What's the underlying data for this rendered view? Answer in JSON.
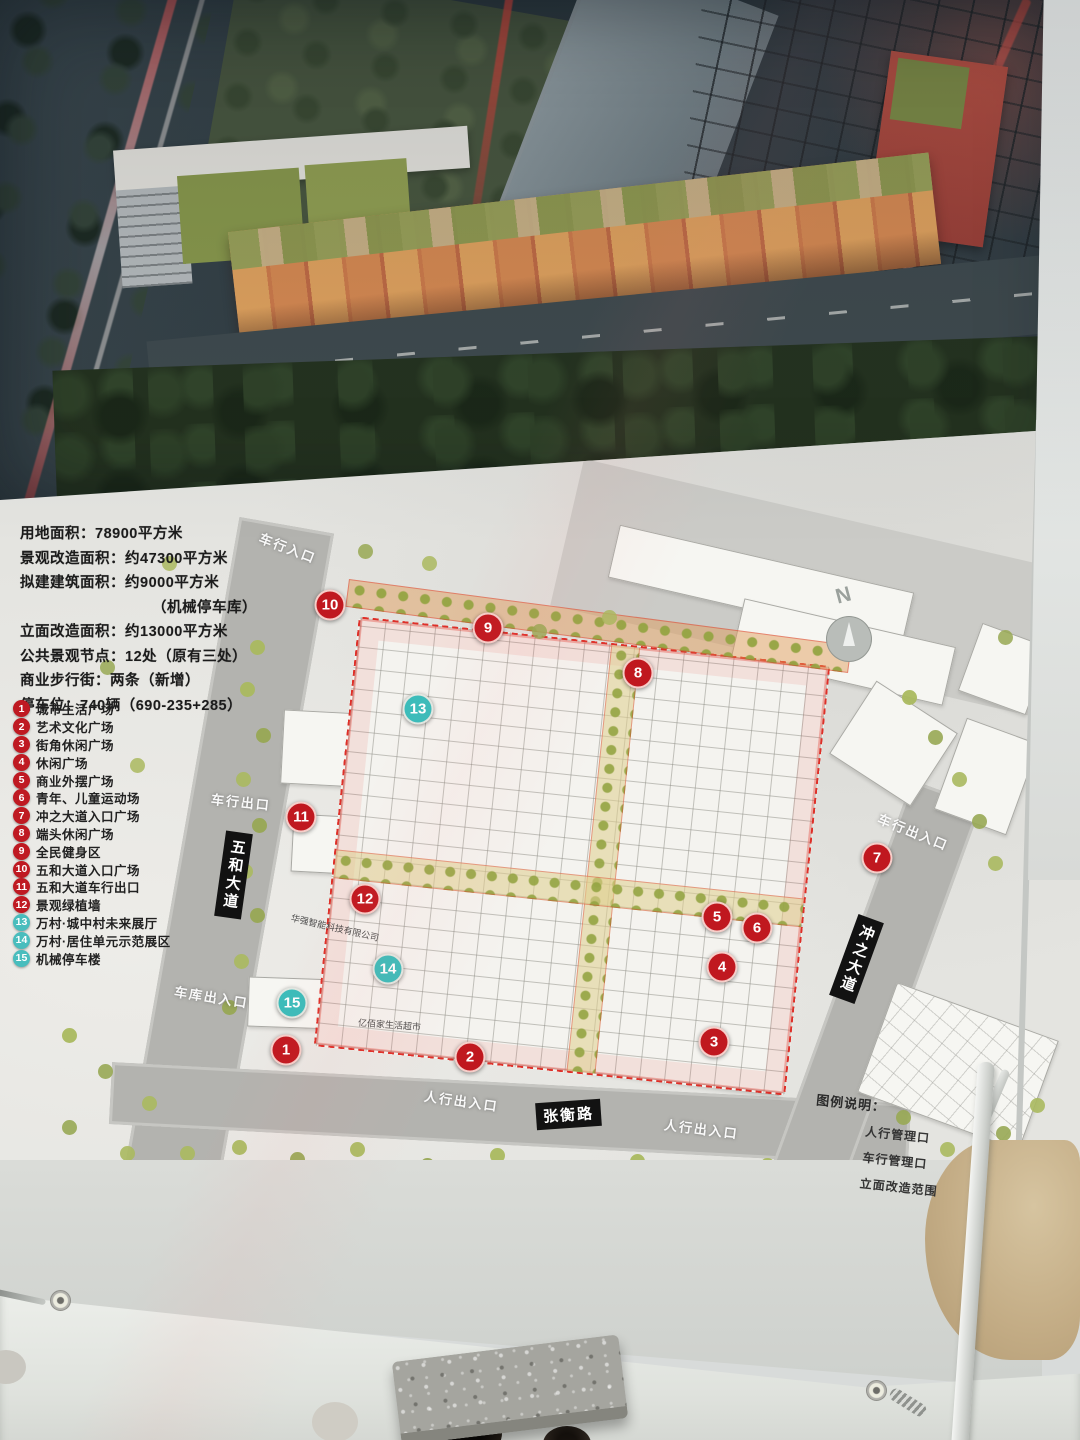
{
  "plan": {
    "stats_lines": [
      {
        "text": "用地面积：78900平方米",
        "indent": false
      },
      {
        "text": "景观改造面积：约47300平方米",
        "indent": false
      },
      {
        "text": "拟建建筑面积：约9000平方米",
        "indent": false
      },
      {
        "text": "（机械停车库）",
        "indent": true
      },
      {
        "text": "立面改造面积：约13000平方米",
        "indent": false
      },
      {
        "text": "公共景观节点：12处（原有三处）",
        "indent": false
      },
      {
        "text": "商业步行街：两条（新增）",
        "indent": false
      },
      {
        "text": "停车位：740辆（690-235+285）",
        "indent": false
      }
    ],
    "legend_items": [
      {
        "num": "1",
        "label": "城市生活广场",
        "color": "red"
      },
      {
        "num": "2",
        "label": "艺术文化广场",
        "color": "red"
      },
      {
        "num": "3",
        "label": "街角休闲广场",
        "color": "red"
      },
      {
        "num": "4",
        "label": "休闲广场",
        "color": "red"
      },
      {
        "num": "5",
        "label": "商业外摆广场",
        "color": "red"
      },
      {
        "num": "6",
        "label": "青年、儿童运动场",
        "color": "red"
      },
      {
        "num": "7",
        "label": "冲之大道入口广场",
        "color": "red"
      },
      {
        "num": "8",
        "label": "端头休闲广场",
        "color": "red"
      },
      {
        "num": "9",
        "label": "全民健身区",
        "color": "red"
      },
      {
        "num": "10",
        "label": "五和大道入口广场",
        "color": "red"
      },
      {
        "num": "11",
        "label": "五和大道车行出口",
        "color": "red"
      },
      {
        "num": "12",
        "label": "景观绿植墙",
        "color": "red"
      },
      {
        "num": "13",
        "label": "万村·城中村未来展厅",
        "color": "teal"
      },
      {
        "num": "14",
        "label": "万村·居住单元示范展区",
        "color": "teal"
      },
      {
        "num": "15",
        "label": "机械停车楼",
        "color": "teal"
      }
    ],
    "markers": [
      {
        "num": "1",
        "color": "red",
        "x": 286,
        "y": 1050
      },
      {
        "num": "2",
        "color": "red",
        "x": 470,
        "y": 1057
      },
      {
        "num": "3",
        "color": "red",
        "x": 714,
        "y": 1042
      },
      {
        "num": "4",
        "color": "red",
        "x": 722,
        "y": 967
      },
      {
        "num": "5",
        "color": "red",
        "x": 717,
        "y": 917
      },
      {
        "num": "6",
        "color": "red",
        "x": 757,
        "y": 928
      },
      {
        "num": "7",
        "color": "red",
        "x": 877,
        "y": 858
      },
      {
        "num": "8",
        "color": "red",
        "x": 638,
        "y": 673
      },
      {
        "num": "9",
        "color": "red",
        "x": 488,
        "y": 628
      },
      {
        "num": "10",
        "color": "red",
        "x": 330,
        "y": 605
      },
      {
        "num": "11",
        "color": "red",
        "x": 301,
        "y": 817
      },
      {
        "num": "12",
        "color": "red",
        "x": 365,
        "y": 899
      },
      {
        "num": "13",
        "color": "teal",
        "x": 418,
        "y": 709
      },
      {
        "num": "14",
        "color": "teal",
        "x": 388,
        "y": 969
      },
      {
        "num": "15",
        "color": "teal",
        "x": 292,
        "y": 1003
      }
    ],
    "map_labels": [
      {
        "name": "entrance-label-vehicle-in",
        "kind": "entrance",
        "text": "车行入口",
        "x": 258,
        "y": 538,
        "rot": 21
      },
      {
        "name": "entrance-label-vehicle-out",
        "kind": "entrance",
        "text": "车行出口",
        "x": 211,
        "y": 792,
        "rot": 6
      },
      {
        "name": "entrance-label-garage",
        "kind": "entrance",
        "text": "车库出入口",
        "x": 174,
        "y": 987,
        "rot": 9
      },
      {
        "name": "entrance-label-pedestrian-sw",
        "kind": "entrance",
        "text": "人行出入口",
        "x": 424,
        "y": 1091,
        "rot": 8
      },
      {
        "name": "entrance-label-pedestrian-se",
        "kind": "entrance",
        "text": "人行出入口",
        "x": 664,
        "y": 1119,
        "rot": 7
      },
      {
        "name": "entrance-label-vehicle-east",
        "kind": "entrance",
        "text": "车行出入口",
        "x": 876,
        "y": 822,
        "rot": 22
      },
      {
        "name": "road-label-wuhe",
        "kind": "roadbox vertical",
        "text": "五和大道",
        "x": 220,
        "y": 832,
        "rot": 8
      },
      {
        "name": "road-label-zhangheng",
        "kind": "roadbox",
        "text": "张衡路",
        "x": 536,
        "y": 1101,
        "rot": -4
      },
      {
        "name": "road-label-chongzhi",
        "kind": "roadbox vertical",
        "text": "冲之大道",
        "x": 843,
        "y": 916,
        "rot": 20
      },
      {
        "name": "building-label-company",
        "kind": "smalltext",
        "text": "华强智能科技有限公司",
        "x": 290,
        "y": 921,
        "rot": 13
      },
      {
        "name": "building-label-supermarket",
        "kind": "smalltext",
        "text": "亿佰家生活超市",
        "x": 358,
        "y": 1018,
        "rot": 4
      }
    ],
    "compass_label": "N",
    "map_legend": {
      "title": "图例说明：",
      "items": [
        "人行管理口",
        "车行管理口",
        "立面改造范围"
      ]
    },
    "colors": {
      "marker_red": "#c0181f",
      "marker_teal": "#3bbcba",
      "boundary_red": "#de2f28"
    }
  }
}
